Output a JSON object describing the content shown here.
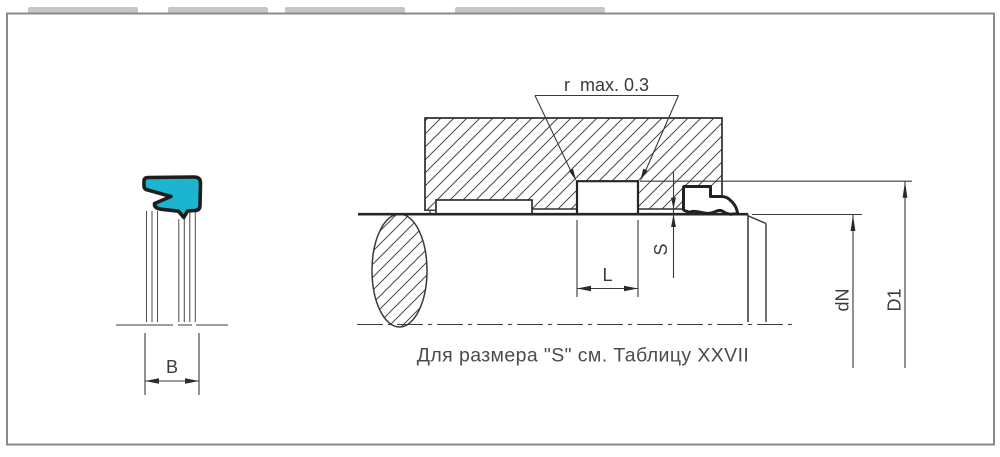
{
  "drawing": {
    "note": "Для размера \"S\" см. Таблицу XXVII",
    "radius_callout": "r  max. 0.3",
    "dim_b": "B",
    "dim_l": "L",
    "dim_s": "S",
    "dim_dn": "dN",
    "dim_d1": "D1",
    "colors": {
      "seal_fill": "#1CB5D0",
      "outline": "#2B2A27",
      "dim_line": "#3A3A38",
      "frame": "#8A8A8A",
      "note_text": "#4B4B4B"
    }
  }
}
